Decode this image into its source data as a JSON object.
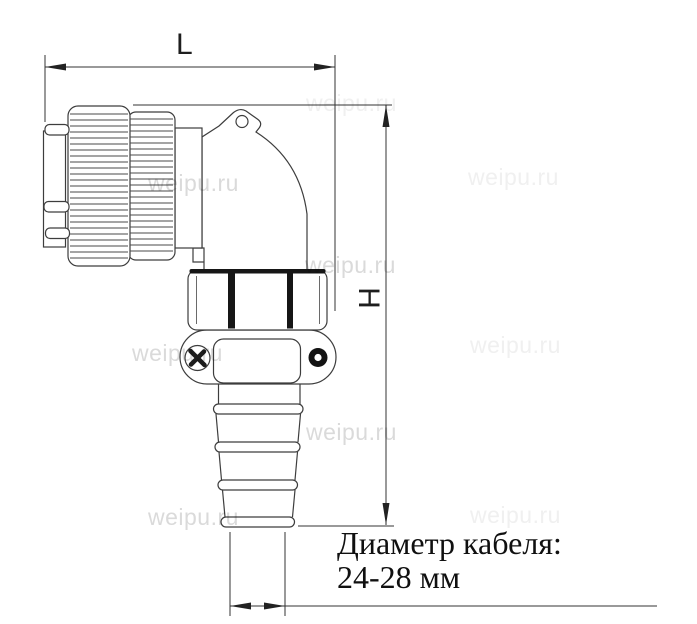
{
  "diagram": {
    "type": "technical-dimension-drawing",
    "subject": "right-angle circular connector with cable gland",
    "labels": {
      "length_dim": "L",
      "height_dim": "H"
    },
    "cable_note": {
      "line1": "Диаметр кабеля:",
      "line2": "24-28 мм"
    },
    "cable_diameter_range_mm": "24-28"
  },
  "watermark": {
    "text": "weipu.ru"
  },
  "colors": {
    "background": "#ffffff",
    "outline": "#3d3d3d",
    "dimension_line": "#333333",
    "black_detail": "#161616",
    "watermark": "#d6d6d6"
  }
}
